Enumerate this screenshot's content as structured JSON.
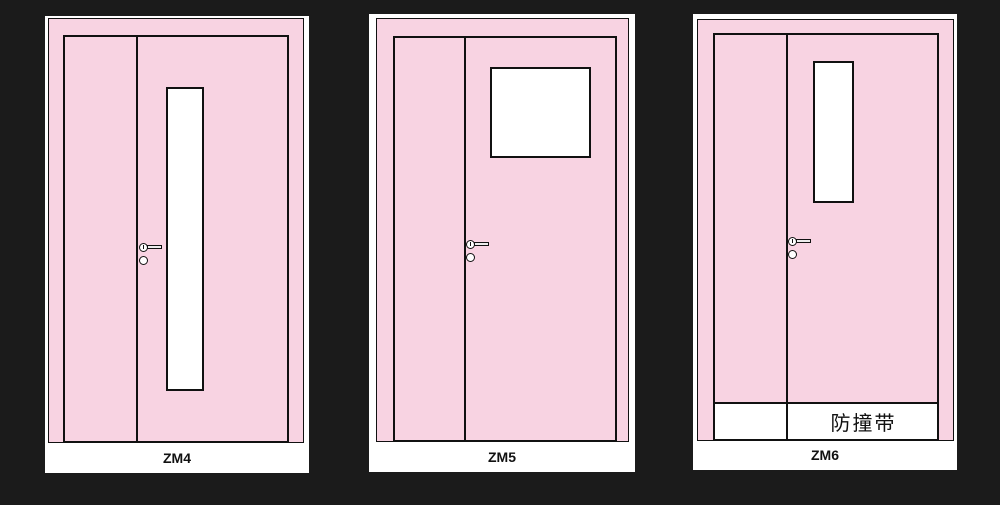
{
  "figure": {
    "background_color": "#1B1B1B",
    "card_color": "#FFFFFF",
    "door_color": "#F8D3E2",
    "line_color": "#111111"
  },
  "doors": [
    {
      "label": "ZM4"
    },
    {
      "label": "ZM5"
    },
    {
      "label": "ZM6",
      "strip_label": "防撞带"
    }
  ]
}
